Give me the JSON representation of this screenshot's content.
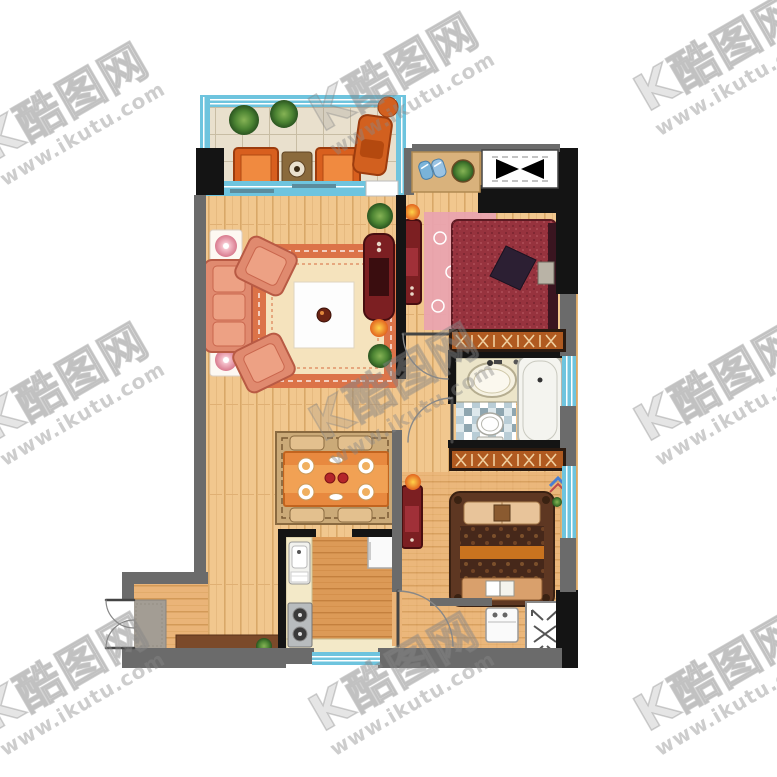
{
  "watermark": {
    "logo_prefix": "K",
    "logo_text": "酷图网",
    "url_text": "www.ikutu.com",
    "color": "#878787",
    "rotation_deg": -30,
    "tile_cols": 3,
    "tile_rows": 3
  },
  "palette": {
    "background": "#ffffff",
    "wall_black": "#141414",
    "wall_gray": "#6b6b6b",
    "window_blue": "#6ec4de",
    "window_blue_dark": "#3f9fc0",
    "balcony_tile": "#e9e0cd",
    "wood_light": "#f1c78e",
    "wood_entry": "#e8b272",
    "wood_kitchen": "#dc9a57",
    "sofa_salmon": "#e08a6f",
    "sofa_cushion": "#eda184",
    "rug_border_orange": "#dc7348",
    "rug_inner_cream": "#f5e3bd",
    "coffee_table_white": "#fdfdfd",
    "furniture_darkred": "#7c1f22",
    "bed_red": "#97333e",
    "pillow_dark": "#2c1f33",
    "rug_pink": "#e9a3b0",
    "wardrobe_orange": "#b05a20",
    "bed2_brown": "#5e3722",
    "bed2_duvet": "#46281a",
    "bed2_stripe": "#c9731f",
    "bed2_pillow": "#e8c49a",
    "vanity_cream": "#ece5c9",
    "tub_white": "#f4f4ef",
    "mosaic_blue": "#b9cdd6",
    "counter_cream": "#f3e9c8",
    "stove_gray": "#b8bcbe",
    "fridge_white": "#fafafa",
    "doormat_gray": "#a39d94",
    "shoe_cabinet_brown": "#7b4a2a",
    "dining_rug_tan": "#cbaa78",
    "dining_cloth_orange": "#e8893f",
    "plant_green": "#3e7a2e",
    "elevator_black": "#000000"
  },
  "rooms": [
    {
      "id": "balcony"
    },
    {
      "id": "living-room"
    },
    {
      "id": "dining-area"
    },
    {
      "id": "master-bedroom"
    },
    {
      "id": "bathroom"
    },
    {
      "id": "second-bedroom"
    },
    {
      "id": "kitchen"
    },
    {
      "id": "entry"
    },
    {
      "id": "elevator"
    }
  ]
}
